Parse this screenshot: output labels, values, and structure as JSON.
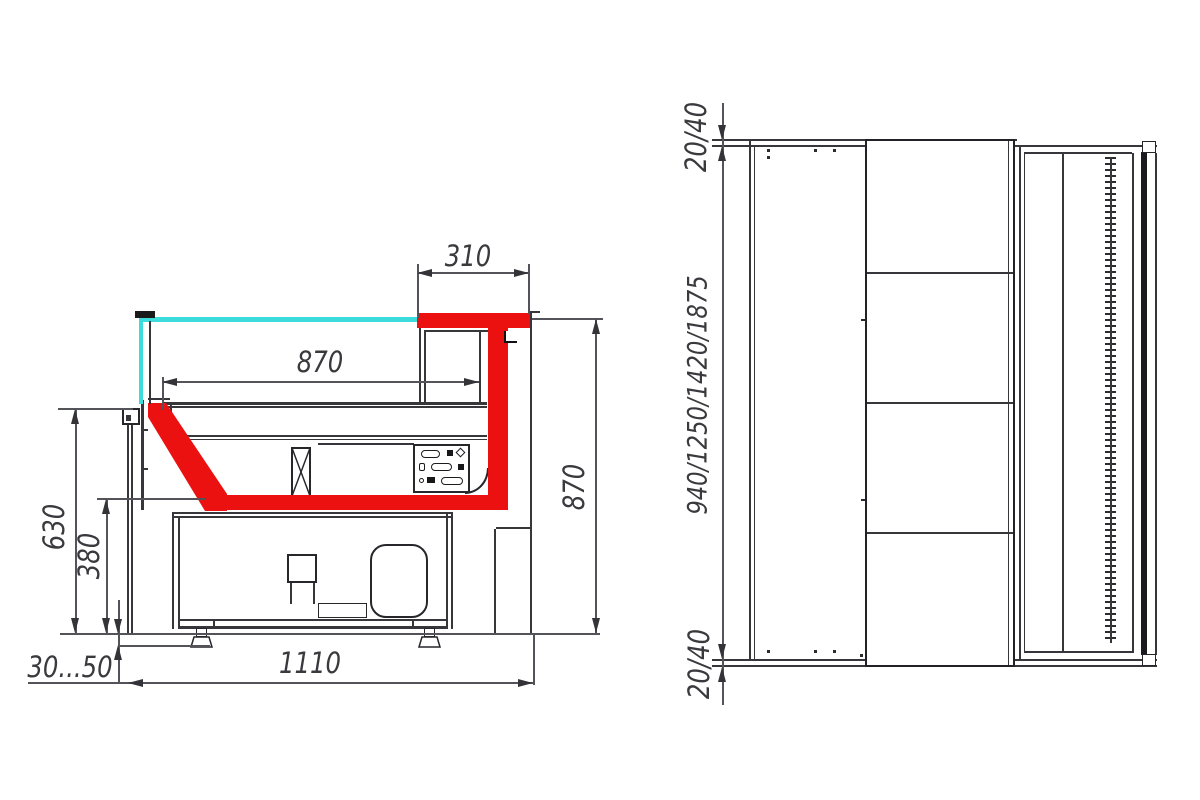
{
  "colors": {
    "highlight_red": "#ec1111",
    "glass_cyan": "#3cdcdd",
    "line_dark": "#2e2e33",
    "dim_line": "#53535a"
  },
  "side_view": {
    "labels": {
      "canopy_depth": "310",
      "shelf_depth": "870",
      "overall_height": "870",
      "front_height": "630",
      "well_floor_height": "380",
      "overall_depth": "1110",
      "foot_adjust": "30...50"
    }
  },
  "top_view": {
    "labels": {
      "top_panel_thickness": "20/40",
      "length_options": "940/1250/1420/1875",
      "bottom_panel_thickness": "20/40"
    }
  }
}
